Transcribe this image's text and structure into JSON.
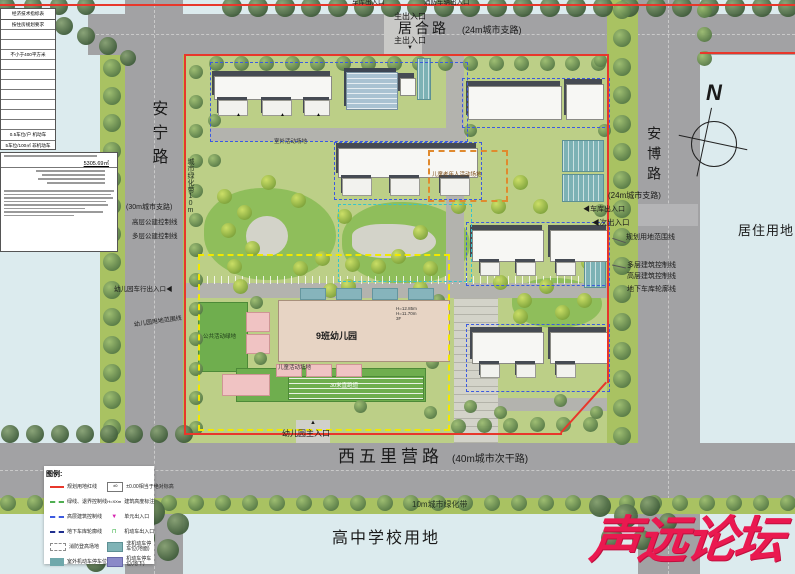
{
  "compass": {
    "label": "N"
  },
  "watermark": {
    "text": "声远论坛",
    "color": "#ea1950"
  },
  "icons": {
    "arrow_down": "▼",
    "arrow_up": "▲",
    "arrow_left": "◀",
    "entry_tri": "▲"
  },
  "roads": {
    "top": {
      "name": "居合路",
      "spec": "(24m城市支路)"
    },
    "left": {
      "name": "安宁路",
      "spec": "(30m城市支路)"
    },
    "right": {
      "name": "安博路",
      "spec": "(24m城市支路)"
    },
    "bottom": {
      "name": "西五里营路",
      "spec": "(40m城市次干路)"
    }
  },
  "adjacent_areas": {
    "east": "居住用地",
    "south": "高中学校用地"
  },
  "green_belts": {
    "south_strip": "10m城市绿化带",
    "left_outer": "城市绿化带",
    "left_outer_width": "10m",
    "left_inner": "城市绿化带",
    "left_inner_width": "10m"
  },
  "entrances": {
    "main_top_upper": "主出入口",
    "main_top_lower": "主出入口",
    "garage_top": "车库出入口",
    "fire_top": "消防车辆出入口",
    "garage_right": "车库出入口",
    "secondary_right": "次出入口",
    "kg_vehicle_left": "幼儿园车行出入口",
    "kg_main_bottom": "幼儿园主入口"
  },
  "control_lines": {
    "left_high": "高层公建控制线",
    "left_multi": "多层公建控制线",
    "right_boundary": "规划用地范围线",
    "right_multi": "多层建筑控制线",
    "right_high": "高层建筑控制线",
    "right_garage": "地下车库轮廓线"
  },
  "site_labels": {
    "kg_boundary": "幼儿园用地范围线",
    "outdoor_activity": "室外活动场地",
    "kids_elderly": "儿童老年人活动场地",
    "public_green": "公共活动绿地",
    "kids_play": "儿童活动场地",
    "track": "30米直跑道"
  },
  "kindergarten": {
    "name": "9班幼儿园",
    "h1": "H=12.85m",
    "h2": "H=11.70m",
    "floors": "3F"
  },
  "legend": {
    "title": "图例:",
    "left": [
      {
        "label": "规划用地红线"
      },
      {
        "label": "绿线、退界控制线"
      },
      {
        "label": "高层建筑控制线"
      },
      {
        "label": "地下车库轮廓线"
      },
      {
        "label": "消防登高场地"
      },
      {
        "label": "室外机动车停车位"
      }
    ],
    "right": [
      {
        "icon": "±0",
        "label": "±0.00相当于绝对标高"
      },
      {
        "icon": "H=XXm",
        "label": "建筑高度标注"
      },
      {
        "icon": "▼",
        "label": "单元出入口"
      },
      {
        "icon": "⊓",
        "label": "机动车出入口"
      },
      {
        "icon": "",
        "label": "非机动车停车位(地面)"
      },
      {
        "icon": "",
        "label": "机动车停车位(地下)"
      }
    ]
  },
  "tables": {
    "t1_title": "经济技术指标表",
    "t1_rows": [
      "按住房规划要求",
      "",
      "",
      "不小于400平方米",
      "",
      "",
      "",
      "",
      "",
      "",
      "",
      "0.5车位/户 机动车",
      "5车位/100㎡ 非机动车"
    ],
    "t2_area": "5305.69㎡"
  }
}
